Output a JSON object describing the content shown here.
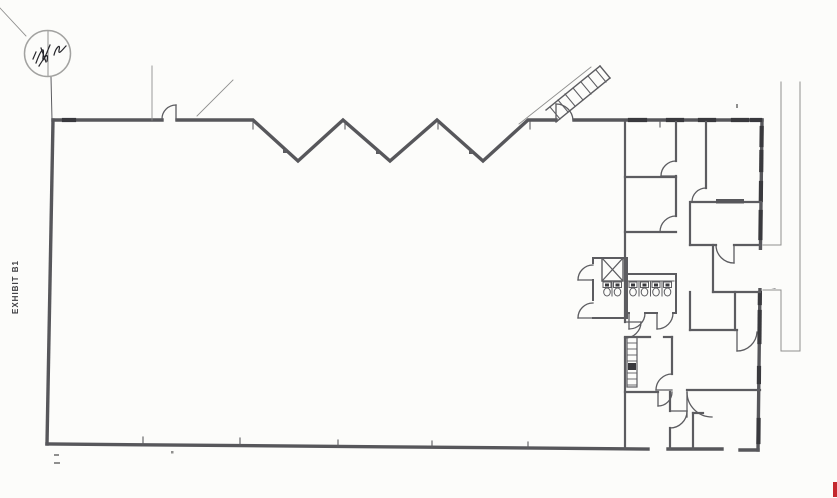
{
  "labels": {
    "exhibit": "EXHIBIT B1"
  },
  "colors": {
    "paper": "#fcfcfa",
    "wall": "#57575b",
    "partition": "#5c5c60",
    "thin": "#8f8f8e",
    "dark": "#39393d",
    "stamp": "#a2a2a0",
    "ink": "#26262b",
    "red": "#c4282d"
  },
  "floorplan": {
    "width": 837,
    "height": 498,
    "layers": [
      {
        "name": "dock-walkway-lines",
        "w": 1,
        "color": "thin",
        "lines": [
          [
            781,
            82,
            781,
            245
          ],
          [
            781,
            245,
            763,
            245
          ],
          [
            763,
            290,
            781,
            290
          ],
          [
            781,
            290,
            781,
            351
          ],
          [
            800,
            82,
            800,
            351
          ],
          [
            781,
            351,
            800,
            351
          ]
        ]
      },
      {
        "name": "building-outline",
        "w": 3.4,
        "color": "wall",
        "paths": [
          {
            "d": "M53,120 H162"
          },
          {
            "d": "M177,120 H253 L298,161 L343,120 L390,161 L437,120 L483,161 L528,120 H556"
          },
          {
            "d": "M574,120 H762"
          },
          {
            "d": "M53,120 L47,444"
          },
          {
            "d": "M47,444 L648,449"
          },
          {
            "d": "M668,449 L722,449"
          },
          {
            "d": "M740,450 L758,450"
          },
          {
            "d": "M762,120 L758,450"
          }
        ]
      },
      {
        "name": "window-dashes",
        "w": 4.2,
        "color": "dark",
        "lines": [
          [
            64,
            120,
            74,
            120
          ],
          [
            630,
            120,
            645,
            120
          ],
          [
            668,
            120,
            682,
            120
          ],
          [
            700,
            120,
            714,
            120
          ],
          [
            733,
            120,
            747,
            120
          ],
          [
            752,
            120,
            760,
            120
          ],
          [
            761.7,
            128,
            761.5,
            145
          ],
          [
            761.4,
            152,
            761.2,
            170
          ],
          [
            761,
            183,
            760.8,
            200
          ],
          [
            760.7,
            212,
            760.4,
            238
          ],
          [
            759.9,
            293,
            759.8,
            303
          ],
          [
            759.7,
            312,
            759.4,
            342
          ],
          [
            759,
            368,
            758.9,
            382
          ],
          [
            758.6,
            420,
            758.4,
            442
          ]
        ]
      },
      {
        "name": "wall-break-symbol",
        "w": 1.2,
        "color": "partition",
        "rects": [
          {
            "x": 757,
            "y": 250,
            "w": 22,
            "h": 38,
            "fill": "paper"
          }
        ],
        "paths": [
          {
            "d": "M758,256 C771,257 776,262 766,267 C756,272 760,278 775,280"
          },
          {
            "d": "M758,264 C771,265 776,270 766,275 C756,280 760,286 775,288"
          }
        ]
      },
      {
        "name": "grid-ticks-and-leaders",
        "w": 1.1,
        "color": "partition",
        "lines": [
          [
            253,
            122,
            253,
            129
          ],
          [
            345,
            122,
            345,
            129
          ],
          [
            438,
            122,
            438,
            129
          ],
          [
            530,
            122,
            530,
            129
          ],
          [
            660,
            121,
            660,
            127
          ],
          [
            143,
            437,
            143,
            445
          ],
          [
            240,
            438,
            240,
            446
          ],
          [
            338,
            440,
            338,
            447
          ],
          [
            432,
            441,
            432,
            448
          ],
          [
            528,
            442,
            528,
            449
          ],
          [
            152,
            66,
            152,
            120,
            0.9,
            "thin"
          ],
          [
            197,
            116,
            233,
            80,
            0.9,
            "thin"
          ],
          [
            51,
            77,
            52,
            120,
            1,
            "partition"
          ],
          [
            0,
            8,
            26,
            36,
            0.9,
            "thin"
          ]
        ]
      },
      {
        "name": "office-partitions",
        "w": 2.2,
        "color": "partition",
        "lines": [
          [
            625,
            122,
            625,
            322
          ],
          [
            625,
            338,
            625,
            448
          ],
          [
            676,
            122,
            676,
            161
          ],
          [
            676,
            176,
            676,
            216
          ],
          [
            706,
            122,
            706,
            188
          ],
          [
            690,
            202,
            690,
            245
          ],
          [
            713,
            245,
            713,
            292
          ],
          [
            690,
            292,
            690,
            330
          ],
          [
            735,
            292,
            735,
            330
          ],
          [
            672,
            337,
            672,
            374
          ],
          [
            670,
            392,
            670,
            411
          ],
          [
            670,
            428,
            670,
            449
          ],
          [
            693,
            413,
            693,
            449
          ],
          [
            625,
            177,
            676,
            177
          ],
          [
            625,
            232,
            676,
            232
          ],
          [
            691,
            202,
            716,
            202
          ],
          [
            744,
            202,
            761,
            202
          ],
          [
            690,
            245,
            716,
            245
          ],
          [
            734,
            245,
            760,
            245
          ],
          [
            713,
            292,
            760,
            292
          ],
          [
            690,
            330,
            737,
            330
          ],
          [
            625,
            337,
            650,
            337
          ],
          [
            664,
            337,
            672,
            337
          ],
          [
            625,
            392,
            658,
            392
          ],
          [
            687,
            390,
            760,
            390
          ],
          [
            693,
            413,
            703,
            413
          ]
        ],
        "rects": [
          {
            "x": 716,
            "y": 199,
            "w": 28,
            "h": 4.5,
            "fill": "wall"
          }
        ]
      },
      {
        "name": "door-swings",
        "w": 1.3,
        "color": "partition",
        "lines": [
          [
            176,
            120,
            176,
            105
          ],
          [
            556,
            120,
            556,
            104
          ],
          [
            676,
            176,
            661,
            176
          ],
          [
            676,
            232,
            660,
            232
          ],
          [
            706,
            202,
            692,
            202
          ],
          [
            734,
            245,
            734,
            263
          ],
          [
            593,
            280,
            578,
            280
          ],
          [
            593,
            318,
            578,
            318
          ],
          [
            629,
            313,
            629,
            329
          ],
          [
            657,
            313,
            657,
            329
          ],
          [
            672,
            390,
            656,
            390
          ],
          [
            658,
            392,
            658,
            406
          ],
          [
            670,
            411,
            687,
            411
          ],
          [
            687,
            392,
            687,
            417
          ],
          [
            737,
            330,
            737,
            351
          ],
          [
            625,
            322,
            641,
            322
          ]
        ],
        "paths": [
          {
            "d": "M176,105 A14,14 0 0 0 162,119"
          },
          {
            "d": "M556,104 A17,17 0 0 1 573,120"
          },
          {
            "d": "M661,176 A15,15 0 0 1 676,161"
          },
          {
            "d": "M660,232 A16,16 0 0 1 676,216"
          },
          {
            "d": "M692,202 A14,14 0 0 1 706,188"
          },
          {
            "d": "M716,245 A18,18 0 0 0 734,263"
          },
          {
            "d": "M578,280 A15,15 0 0 1 593,265"
          },
          {
            "d": "M578,318 A15,15 0 0 1 593,303"
          },
          {
            "d": "M645,313 A16,16 0 0 1 629,329"
          },
          {
            "d": "M673,313 A16,16 0 0 1 657,329"
          },
          {
            "d": "M656,390 A16,16 0 0 1 672,374"
          },
          {
            "d": "M672,392 A14,14 0 0 1 658,406"
          },
          {
            "d": "M687,411 A17,17 0 0 1 670,428"
          },
          {
            "d": "M687,392 A25,25 0 0 0 712,417"
          },
          {
            "d": "M757,332 A20,20 0 0 1 737,351"
          },
          {
            "d": "M641,322 A16,16 0 0 1 625,338"
          }
        ]
      },
      {
        "name": "restrooms",
        "w": 2,
        "color": "partition",
        "lines": [
          [
            593,
            258,
            623,
            258
          ],
          [
            593,
            258,
            593,
            263
          ],
          [
            593,
            280,
            593,
            300
          ],
          [
            593,
            318,
            625,
            318
          ],
          [
            627,
            274,
            676,
            274
          ],
          [
            627,
            258,
            627,
            318
          ],
          [
            676,
            274,
            676,
            313
          ],
          [
            627,
            313,
            629,
            313
          ],
          [
            645,
            313,
            657,
            313
          ],
          [
            673,
            313,
            676,
            313
          ],
          [
            602,
            281,
            623,
            281,
            1
          ],
          [
            628,
            281,
            674,
            281,
            1
          ],
          [
            612,
            281,
            612,
            296,
            1
          ],
          [
            639,
            281,
            639,
            296,
            1
          ],
          [
            650.5,
            281,
            650.5,
            296,
            1
          ],
          [
            662,
            281,
            662,
            296,
            1
          ]
        ],
        "rects": [
          {
            "x": 602,
            "y": 258,
            "w": 21,
            "h": 23,
            "stroke": "partition",
            "sw": 1.4
          },
          {
            "x": 603,
            "y": 282,
            "w": 8,
            "h": 5.5,
            "stroke": "partition",
            "sw": 1
          },
          {
            "x": 605,
            "y": 283.5,
            "w": 4,
            "h": 3,
            "fill": "dark"
          },
          {
            "x": 613.5,
            "y": 282,
            "w": 8,
            "h": 5.5,
            "stroke": "partition",
            "sw": 1
          },
          {
            "x": 615.5,
            "y": 283.5,
            "w": 4,
            "h": 3,
            "fill": "dark"
          },
          {
            "x": 629,
            "y": 282,
            "w": 8,
            "h": 5.5,
            "stroke": "partition",
            "sw": 1
          },
          {
            "x": 631,
            "y": 283.5,
            "w": 4,
            "h": 3,
            "fill": "dark"
          },
          {
            "x": 640.5,
            "y": 282,
            "w": 8,
            "h": 5.5,
            "stroke": "partition",
            "sw": 1
          },
          {
            "x": 642.5,
            "y": 283.5,
            "w": 4,
            "h": 3,
            "fill": "dark"
          },
          {
            "x": 652,
            "y": 282,
            "w": 8,
            "h": 5.5,
            "stroke": "partition",
            "sw": 1
          },
          {
            "x": 654,
            "y": 283.5,
            "w": 4,
            "h": 3,
            "fill": "dark"
          },
          {
            "x": 663.5,
            "y": 282,
            "w": 8,
            "h": 5.5,
            "stroke": "partition",
            "sw": 1
          },
          {
            "x": 665.5,
            "y": 283.5,
            "w": 4,
            "h": 3,
            "fill": "dark"
          }
        ],
        "ellipses": [
          {
            "cx": 607,
            "cy": 292,
            "rx": 3.3,
            "ry": 4,
            "w": 1
          },
          {
            "cx": 617.5,
            "cy": 292,
            "rx": 3.3,
            "ry": 4,
            "w": 1
          },
          {
            "cx": 633,
            "cy": 292,
            "rx": 3.3,
            "ry": 4,
            "w": 1
          },
          {
            "cx": 644.5,
            "cy": 292,
            "rx": 3.3,
            "ry": 4,
            "w": 1
          },
          {
            "cx": 656,
            "cy": 292,
            "rx": 3.3,
            "ry": 4,
            "w": 1
          },
          {
            "cx": 667.5,
            "cy": 292,
            "rx": 3.3,
            "ry": 4,
            "w": 1
          }
        ],
        "paths": [
          {
            "d": "M602,258 L623,281",
            "w": 1.2
          },
          {
            "d": "M602,281 L623,258",
            "w": 1.2
          }
        ]
      },
      {
        "name": "ladder-symbol",
        "w": 1.2,
        "color": "partition",
        "rects": [
          {
            "x": 627,
            "y": 337,
            "w": 10,
            "h": 50,
            "stroke": "partition",
            "sw": 1.2
          },
          {
            "x": 628,
            "y": 363,
            "w": 8,
            "h": 7,
            "fill": "dark"
          }
        ],
        "lines": [
          [
            627,
            343,
            637,
            343,
            0.9
          ],
          [
            627,
            349,
            637,
            349,
            0.9
          ],
          [
            627,
            355,
            637,
            355,
            0.9
          ],
          [
            627,
            361,
            637,
            361,
            0.9
          ],
          [
            627,
            373,
            637,
            373,
            0.9
          ],
          [
            627,
            379,
            637,
            379,
            0.9
          ],
          [
            627,
            385,
            637,
            385,
            0.9
          ]
        ]
      },
      {
        "name": "stair-symbol",
        "w": 1.4,
        "color": "partition",
        "lines": [
          [
            546,
            110,
            600,
            66
          ],
          [
            556,
            122,
            610,
            78
          ],
          [
            600,
            66,
            610,
            78
          ],
          [
            519,
            124,
            591,
            67,
            0.9,
            "thin"
          ],
          [
            550,
            107,
            560,
            119,
            1.1
          ],
          [
            558,
            100,
            568,
            112,
            1.1
          ],
          [
            565,
            94,
            575,
            106,
            1.1
          ],
          [
            573,
            88,
            583,
            100,
            1.1
          ],
          [
            581,
            82,
            591,
            94,
            1.1
          ],
          [
            588,
            76,
            598,
            88,
            1.1
          ],
          [
            596,
            70,
            606,
            82,
            1.1
          ]
        ]
      },
      {
        "name": "surveyor-stamp",
        "w": 1.2,
        "color": "ink",
        "circles": [
          {
            "cx": 47.5,
            "cy": 53.5,
            "r": 23,
            "w": 1.5,
            "color": "stamp"
          }
        ],
        "lines": [
          [
            48,
            31,
            48,
            76,
            1,
            "thin"
          ]
        ],
        "paths": [
          {
            "d": "M36,63 C40,52 45,43 43,57 C42,66 47,52 50,45"
          },
          {
            "d": "M39,66 C44,58 49,50 47,61"
          },
          {
            "d": "M54,55 C56,47 61,43 59,50 C58,56 63,49 66,46"
          },
          {
            "d": "M41,48 L46,62"
          },
          {
            "d": "M33,59 L36,52"
          }
        ]
      },
      {
        "name": "scan-artifacts",
        "w": 1,
        "color": "thin",
        "rects": [
          {
            "x": 833,
            "y": 482,
            "w": 4.5,
            "h": 15,
            "fill": "red"
          },
          {
            "x": 54,
            "y": 454,
            "w": 5,
            "h": 2,
            "fill": "thin"
          },
          {
            "x": 54,
            "y": 462,
            "w": 6,
            "h": 2,
            "fill": "thin"
          },
          {
            "x": 171,
            "y": 451,
            "w": 2.5,
            "h": 2.5,
            "fill": "thin"
          },
          {
            "x": 736,
            "y": 104,
            "w": 2,
            "h": 4,
            "fill": "thin"
          },
          {
            "x": 283,
            "y": 149,
            "w": 4,
            "h": 4,
            "fill": "partition"
          },
          {
            "x": 376,
            "y": 150,
            "w": 4,
            "h": 4,
            "fill": "partition"
          },
          {
            "x": 469,
            "y": 150,
            "w": 4,
            "h": 4,
            "fill": "partition"
          }
        ]
      }
    ]
  }
}
